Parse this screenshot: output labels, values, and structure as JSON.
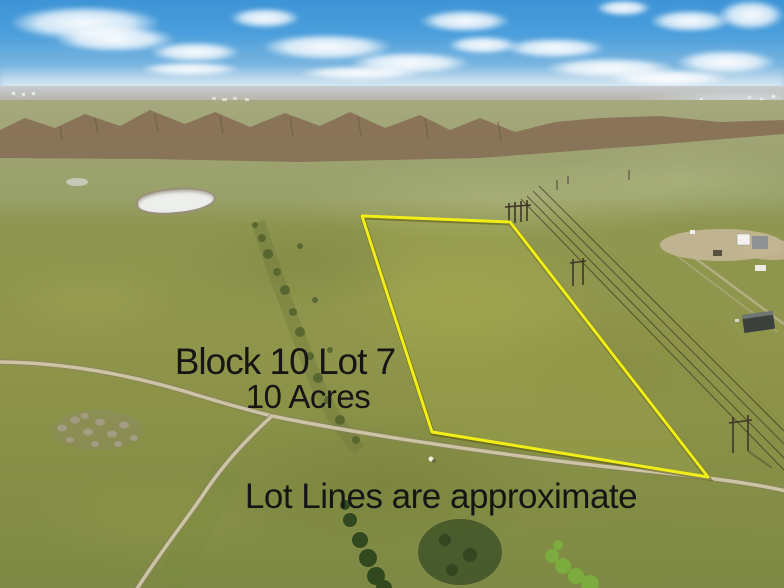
{
  "overlay": {
    "block_label": "Block 10 Lot 7",
    "acreage_label": "10 Acres",
    "disclaimer": "Lot Lines are approximate",
    "text_color": "#151515"
  },
  "lot_boundary": {
    "label": "Block 10 Lot 7 boundary",
    "stroke_color": "#f2ef18",
    "points": "362,216 510,222 708,477 432,432"
  },
  "palette": {
    "sky_top": "#3d94d6",
    "sky_horizon": "#d9e2e7",
    "distant_plain": "#b7b2a4",
    "ridge_brown": "#877056",
    "midground_green": "#9ca370",
    "foreground_grass": "#8f954a",
    "road_tan": "#cdc3a6",
    "pond_white": "#edefec",
    "shrub_dark_green": "#52622e"
  }
}
